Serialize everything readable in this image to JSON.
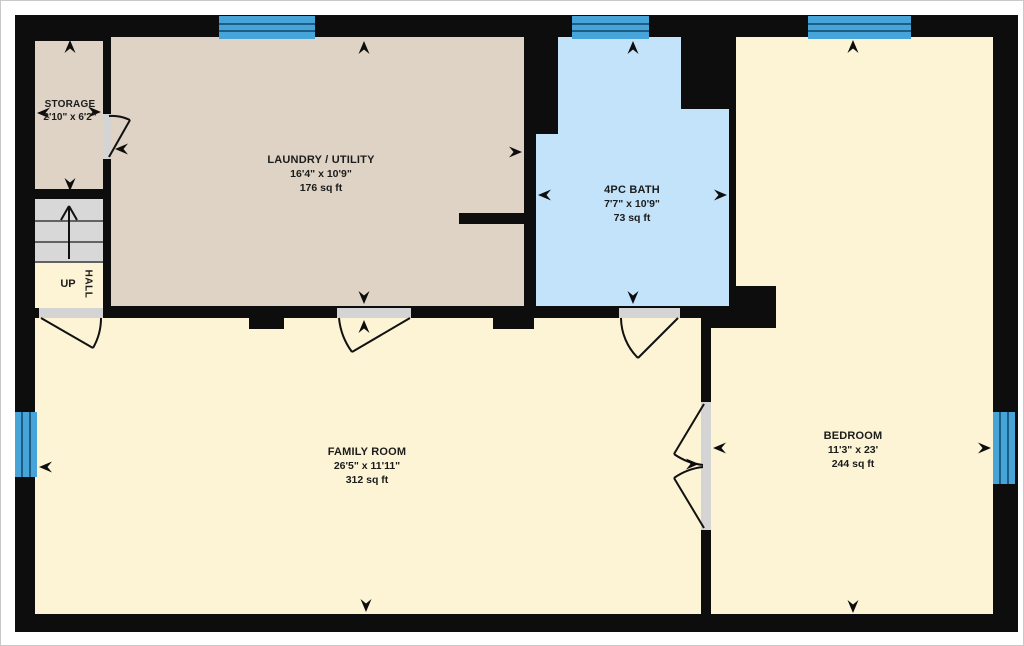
{
  "plan": {
    "type": "floor-plan",
    "rooms": [
      {
        "name": "STORAGE",
        "dimensions": "2'10\" x 6'2\"",
        "area": ""
      },
      {
        "name": "LAUNDRY / UTILITY",
        "dimensions": "16'4\" x 10'9\"",
        "area": "176 sq ft"
      },
      {
        "name": "4PC BATH",
        "dimensions": "7'7\" x 10'9\"",
        "area": "73 sq ft"
      },
      {
        "name": "FAMILY ROOM",
        "dimensions": "26'5\" x 11'11\"",
        "area": "312 sq ft"
      },
      {
        "name": "BEDROOM",
        "dimensions": "11'3\" x 23'",
        "area": "244 sq ft"
      }
    ],
    "stairs": {
      "up_label": "UP",
      "hall_label": "HALL"
    },
    "colors": {
      "wall": "#0d0d0d",
      "laundry_storage_fill": "#ded3c4",
      "bath_fill": "#c2e3f9",
      "cream_room_fill": "#fdf4d5",
      "window_fill": "#47a4d9",
      "window_line": "#1d5e87",
      "stairs_fill": "#d8d8d8",
      "door_jamb": "#d4d4d4",
      "text": "#1c1c1c",
      "page_border": "#c9c9c9"
    }
  }
}
